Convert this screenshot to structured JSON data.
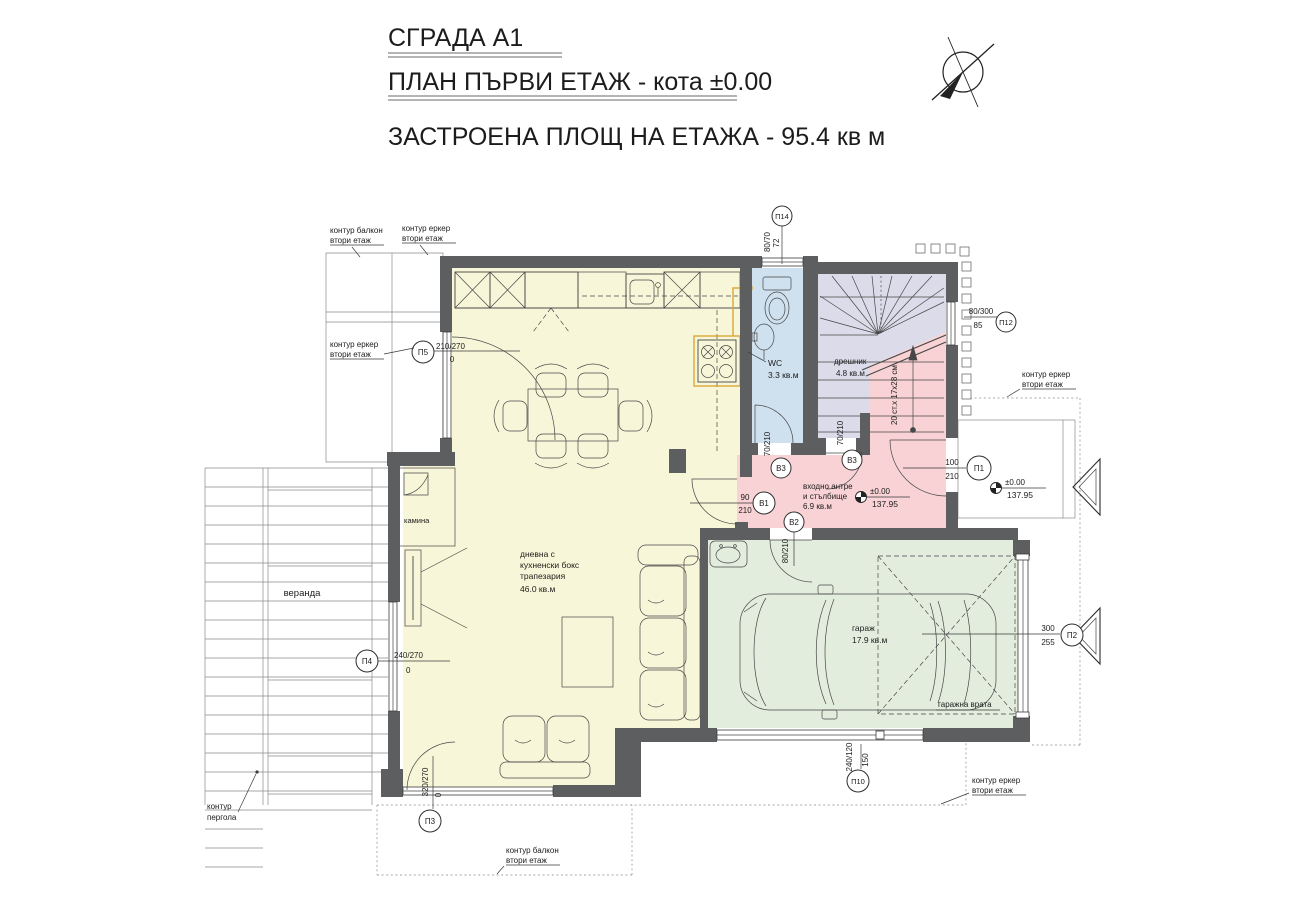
{
  "header": {
    "line1": "СГРАДА А1",
    "line2": "ПЛАН ПЪРВИ ЕТАЖ - кота ±0.00",
    "line3": "ЗАСТРОЕНА ПЛОЩ НА ЕТАЖА - 95.4 кв м"
  },
  "rooms": {
    "living": {
      "l1": "дневна с",
      "l2": "кухненски бокс",
      "l3": "трапезария",
      "area": "46.0 кв.м",
      "color": "#f8f6d8"
    },
    "wc": {
      "name": "WC",
      "area": "3.3 кв.м",
      "color": "#cfe0ee"
    },
    "closet": {
      "name": "дрешник",
      "area": "4.8 кв.м",
      "color": "#dcdbe9"
    },
    "hall": {
      "l1": "входно антре",
      "l2": "и стълбище",
      "area": "6.9 кв.м",
      "color": "#f8d2d4"
    },
    "garage": {
      "name": "гараж",
      "area": "17.9 кв.м",
      "color": "#e3edde"
    },
    "veranda": {
      "name": "веранда"
    },
    "fireplace": {
      "name": "камина"
    }
  },
  "labels": {
    "contour_balcony_l1": "контур балкон",
    "contour_balcony_l2": "втори етаж",
    "contour_bay_l1": "контур еркер",
    "contour_bay_l2": "втори етаж",
    "contour_pergola_l1": "контур",
    "contour_pergola_l2": "пергола",
    "garage_door": "гаражна врата",
    "stairs_note": "20 ст.х 17х28 см"
  },
  "levels": {
    "rel": "±0.00",
    "abs": "137.95"
  },
  "openings": {
    "p5": {
      "tag": "П5",
      "dim": "210/270",
      "sill": "0"
    },
    "p4": {
      "tag": "П4",
      "dim": "240/270",
      "sill": "0"
    },
    "p3": {
      "tag": "П3",
      "dim": "320/270",
      "sill": "0"
    },
    "p14": {
      "tag": "П14",
      "dim": "80/70",
      "sill": "72"
    },
    "p12": {
      "tag": "П12",
      "dim": "80/300",
      "sill": "85"
    },
    "p10": {
      "tag": "П10",
      "dim": "240/120",
      "sill": "150"
    },
    "p1": {
      "tag": "П1",
      "w": "100",
      "h": "210"
    },
    "p2": {
      "tag": "П2",
      "w": "300",
      "h": "255"
    },
    "v1": {
      "tag": "В1",
      "w": "90",
      "h": "210"
    },
    "v2": {
      "tag": "В2",
      "dim": "80/210"
    },
    "v3": {
      "tag": "В3",
      "dim": "70/210"
    }
  }
}
